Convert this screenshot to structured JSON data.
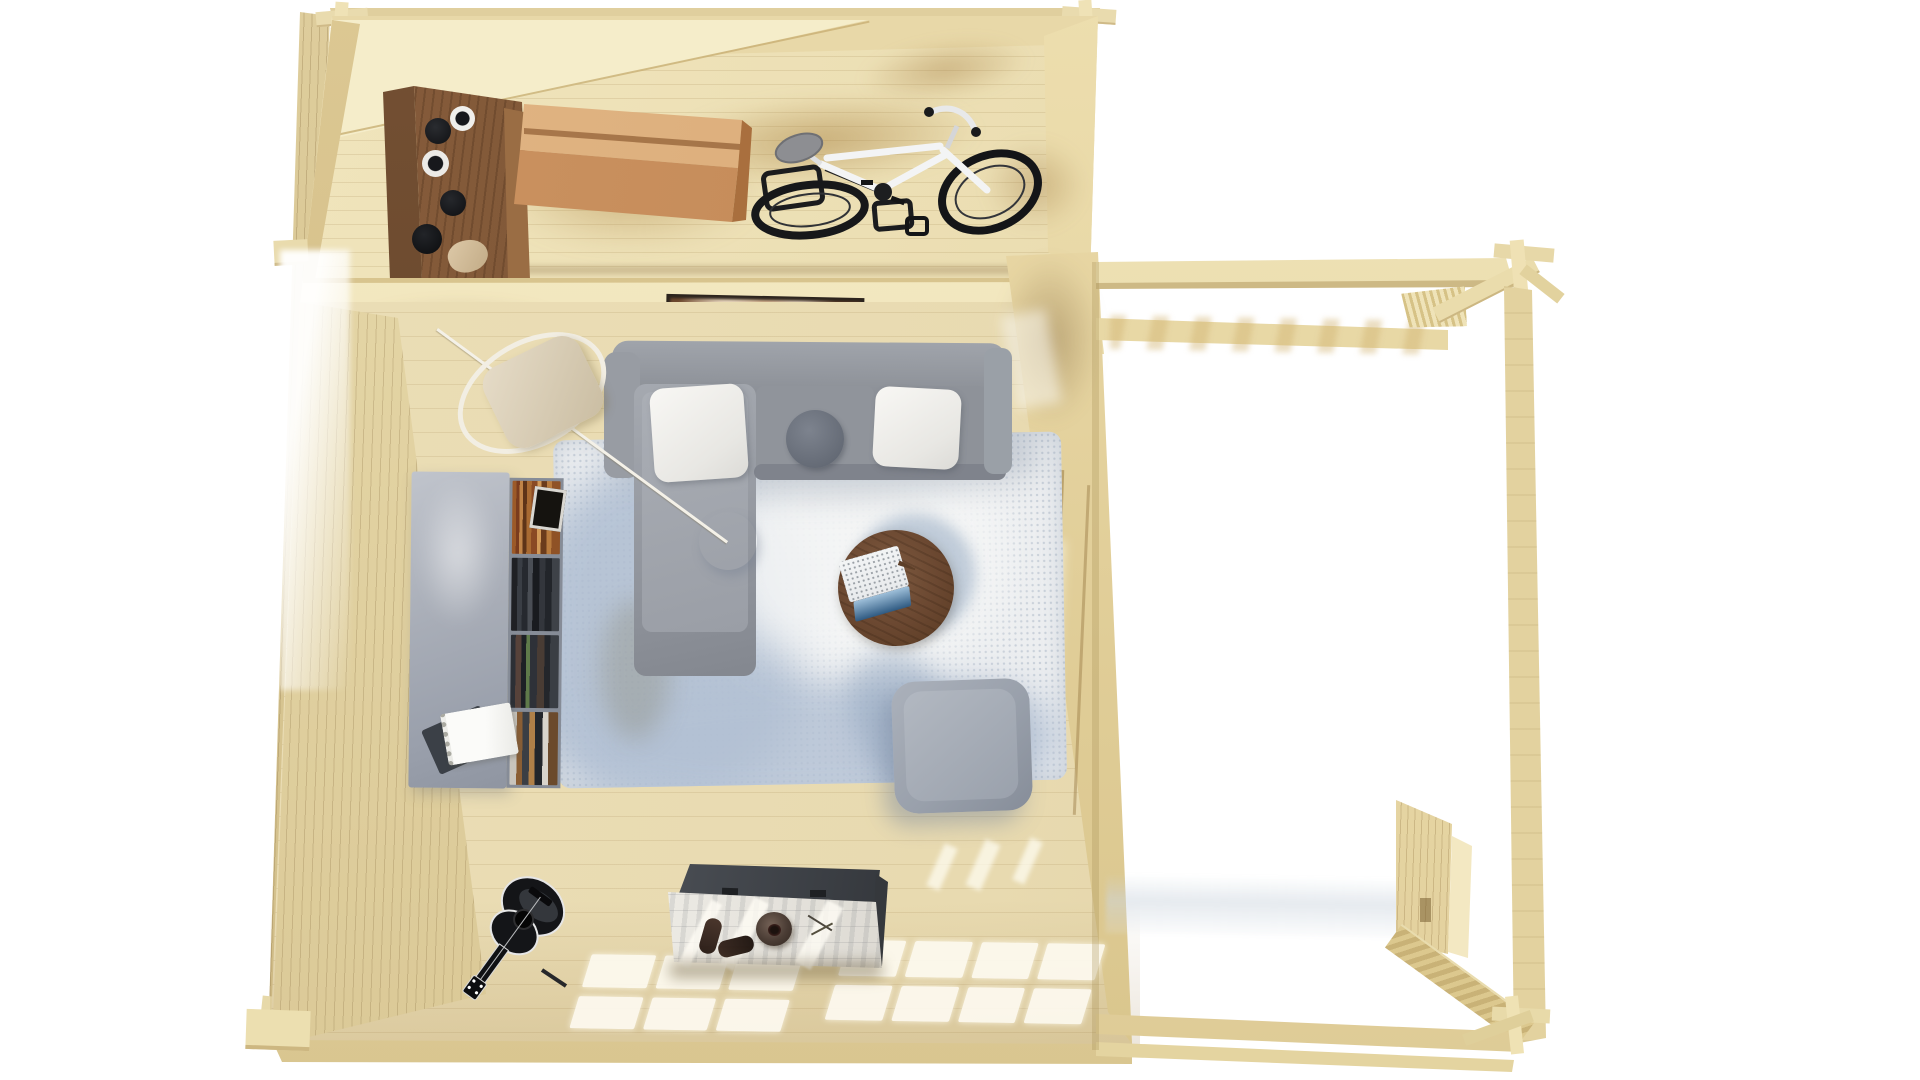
{
  "title": "Top-down 3D render of a wooden garden cabin: storage room with bicycle, living room with sofa and rug, and an attached open pergola",
  "palette": {
    "bg": "#ffffff",
    "floor-storage": "#ecdfb4",
    "floor-living": "#e8dab0",
    "wall-tan": "#e8daab",
    "wall-dark": "#d6c390",
    "divider": "#f4eac4",
    "gable": "#f5edca",
    "cabinet": "#8a5f3c",
    "box-top": "#e4b988",
    "box-front": "#cf9765",
    "bike-frame": "#f3f4f5",
    "bike-dark": "#17181a",
    "sofa": "#8b8f96",
    "sofa-dark": "#7f838c",
    "pillow": "#f8f7f4",
    "cushion-round": "#646a75",
    "rug": "#eceef0",
    "rug-blue": "#aebdd1",
    "shelf": "#a8adb7",
    "table": "#6a4730",
    "laptop": "#f2f4f5",
    "screen": "#2f5a82",
    "lamp": "#ffffff",
    "rope": "#f4f1e8",
    "pouf": "#99a0ab",
    "chest": "#edebe5",
    "chest-lid": "#33363b",
    "guitar": "#17181a",
    "light-patch": "rgba(253,250,240,0.92)",
    "pergola": "#f0e4b8",
    "pergola-dark": "#cdb985",
    "shadow-warm": "#c8a368"
  },
  "scene": {
    "background": "#ffffff",
    "building": {
      "label": "log cabin floor plan, bird's-eye view, white studio background",
      "rooms": [
        {
          "id": "storage-room",
          "label": "storage room (top) with light pine plank floor",
          "objects": [
            "dark walnut wall cabinet",
            "black storage jars",
            "white-wrapped bottles",
            "hanging beige pouch",
            "orange wooden storage box with lid seam",
            "black bike rack",
            "white city bicycle with gray saddle and black wheels",
            "warm sunlight shadows on floor"
          ]
        },
        {
          "id": "living-room",
          "label": "living room (bottom)",
          "objects": [
            "gray sectional sofa with left chaise",
            "two white pillows",
            "round dark gray cushion",
            "white perforated pendant lamp on long diagonal cord",
            "white rope loop with beige hanging cushion",
            "blurry framed picture on partition wall",
            "gray bookshelf filled with multicolored books",
            "small black picture frame on shelf",
            "open white spiral notebook and dark notebook",
            "light blue mottled area rug",
            "round walnut coffee table",
            "open laptop with blue screen",
            "wooden stylus",
            "gray knitted ottoman",
            "black acoustic guitar against south wall",
            "whitewashed storage chest with open dark lid",
            "pair of brown shoes on chest",
            "round brown hat on chest",
            "sunlight window grids projected on floor"
          ]
        },
        {
          "id": "pergola",
          "label": "attached open pergola / carport (right), overexposed white ground",
          "objects": [
            "long top beam",
            "far cross beam",
            "slatted corner wedge",
            "diagonal corner brace",
            "crossed log joints at corners",
            "right side post",
            "slatted side gate panel",
            "herringbone deck strip",
            "double bottom beams",
            "faint gray terrace band"
          ]
        }
      ]
    }
  }
}
